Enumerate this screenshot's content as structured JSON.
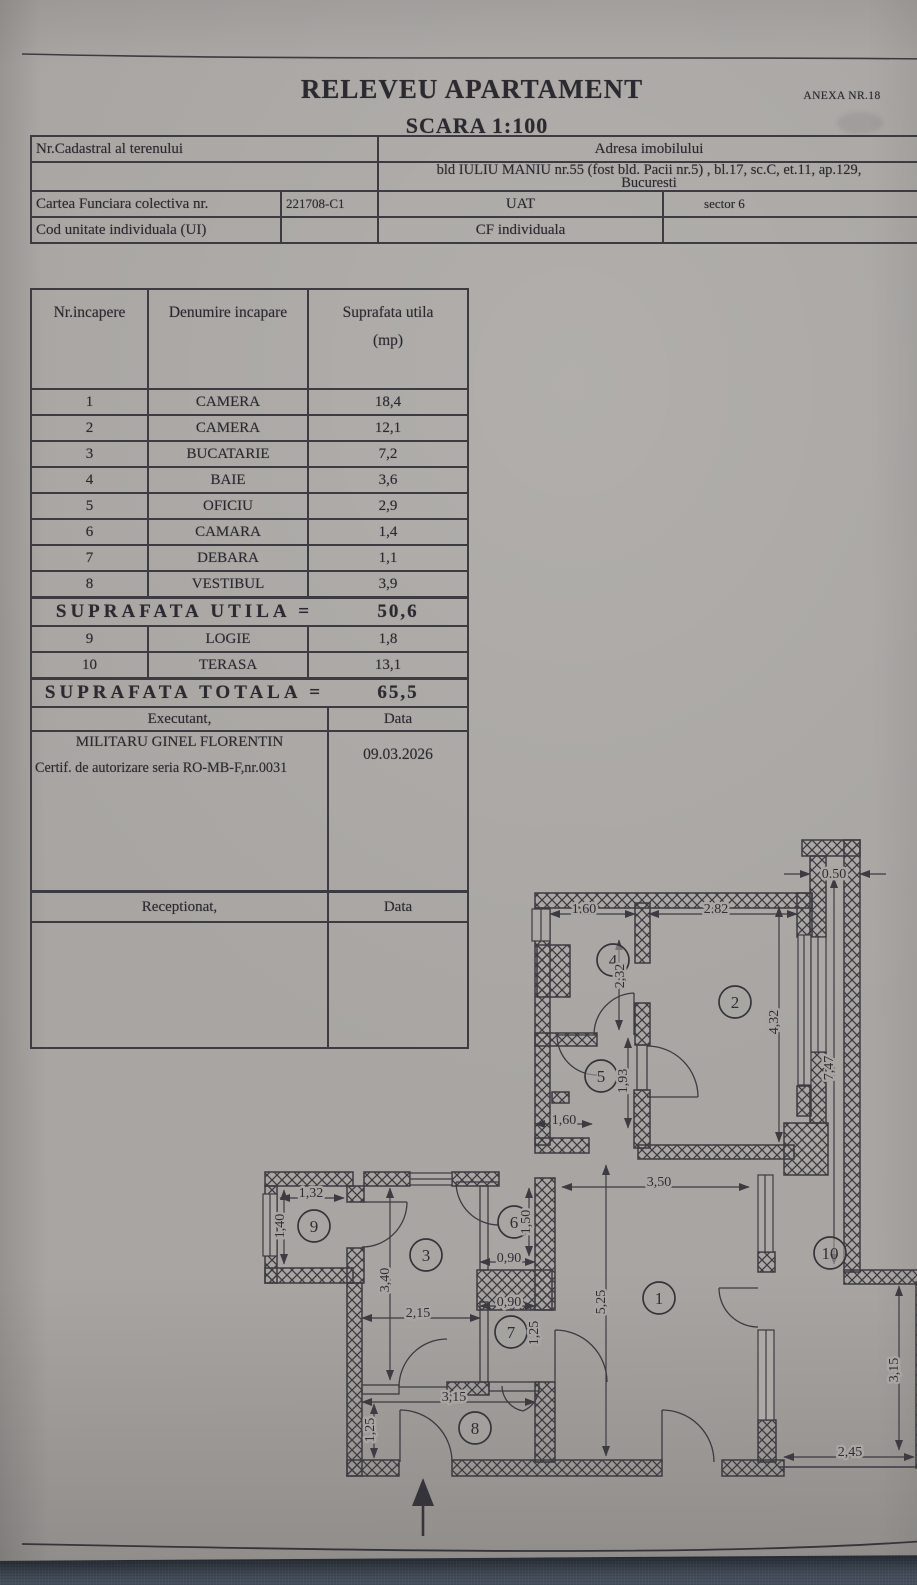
{
  "page": {
    "title": "RELEVEU APARTAMENT",
    "scale": "SCARA 1:100",
    "anexa": "ANEXA NR.18"
  },
  "info": {
    "nr_cadastral": "Nr.Cadastral al terenului",
    "adresa_label": "Adresa imobilului",
    "adresa1": "bld IULIU MANIU nr.55 (fost bld. Pacii nr.5) , bl.17, sc.C, et.11, ap.129,",
    "adresa2": "Bucuresti",
    "cfc_label": "Cartea Funciara colectiva nr.",
    "cfc_value": "221708-C1",
    "uat_label": "UAT",
    "uat_value": "sector 6",
    "cod_label": "Cod unitate individuala (UI)",
    "cfi_label": "CF individuala"
  },
  "rt": {
    "h1": "Nr.incapere",
    "h2": "Denumire incapare",
    "h3a": "Suprafata utila",
    "h3b": "(mp)",
    "rows": [
      {
        "nr": "1",
        "name": "CAMERA",
        "area": "18,4"
      },
      {
        "nr": "2",
        "name": "CAMERA",
        "area": "12,1"
      },
      {
        "nr": "3",
        "name": "BUCATARIE",
        "area": "7,2"
      },
      {
        "nr": "4",
        "name": "BAIE",
        "area": "3,6"
      },
      {
        "nr": "5",
        "name": "OFICIU",
        "area": "2,9"
      },
      {
        "nr": "6",
        "name": "CAMARA",
        "area": "1,4"
      },
      {
        "nr": "7",
        "name": "DEBARA",
        "area": "1,1"
      },
      {
        "nr": "8",
        "name": "VESTIBUL",
        "area": "3,9"
      }
    ],
    "utila_label": "SUPRAFATA UTILA =",
    "utila_value": "50,6",
    "rows2": [
      {
        "nr": "9",
        "name": "LOGIE",
        "area": "1,8"
      },
      {
        "nr": "10",
        "name": "TERASA",
        "area": "13,1"
      }
    ],
    "totala_label": "SUPRAFATA TOTALA =",
    "totala_value": "65,5",
    "executant": "Executant,",
    "data1": "Data",
    "name": "MILITARU GINEL FLORENTIN",
    "cert": "Certif. de autorizare seria RO-MB-F,nr.0031",
    "date": "09.03.2026",
    "receptionat": "Receptionat,",
    "data2": "Data"
  },
  "floorplan": {
    "rooms": [
      {
        "n": "1",
        "x": 637,
        "y": 1268
      },
      {
        "n": "2",
        "x": 713,
        "y": 972
      },
      {
        "n": "3",
        "x": 404,
        "y": 1225
      },
      {
        "n": "4",
        "x": 591,
        "y": 930
      },
      {
        "n": "5",
        "x": 579,
        "y": 1046
      },
      {
        "n": "6",
        "x": 492,
        "y": 1192
      },
      {
        "n": "7",
        "x": 489,
        "y": 1302
      },
      {
        "n": "8",
        "x": 453,
        "y": 1398
      },
      {
        "n": "9",
        "x": 292,
        "y": 1196
      },
      {
        "n": "10",
        "x": 808,
        "y": 1223
      }
    ],
    "dims": [
      {
        "t": "1.60",
        "x": 562,
        "y": 878,
        "r": 0
      },
      {
        "t": "2.82",
        "x": 694,
        "y": 878,
        "r": 0
      },
      {
        "t": "2,32",
        "x": 597,
        "y": 946,
        "r": 90
      },
      {
        "t": "4,32",
        "x": 751,
        "y": 992,
        "r": 90
      },
      {
        "t": "0.50",
        "x": 812,
        "y": 843,
        "r": 0
      },
      {
        "t": "7,47",
        "x": 806,
        "y": 1038,
        "r": 90
      },
      {
        "t": "1,93",
        "x": 600,
        "y": 1051,
        "r": 90
      },
      {
        "t": "1,60",
        "x": 542,
        "y": 1089,
        "r": 0
      },
      {
        "t": "3,50",
        "x": 637,
        "y": 1151,
        "r": 0
      },
      {
        "t": "5,25",
        "x": 578,
        "y": 1272,
        "r": 90
      },
      {
        "t": "1,32",
        "x": 289,
        "y": 1162,
        "r": 0
      },
      {
        "t": "1,40",
        "x": 257,
        "y": 1196,
        "r": 90
      },
      {
        "t": "3,40",
        "x": 362,
        "y": 1250,
        "r": 90
      },
      {
        "t": "2,15",
        "x": 396,
        "y": 1282,
        "r": 0
      },
      {
        "t": "1,50",
        "x": 503,
        "y": 1192,
        "r": 90
      },
      {
        "t": "0,90",
        "x": 487,
        "y": 1227,
        "r": 0
      },
      {
        "t": "0,90",
        "x": 487,
        "y": 1271,
        "r": 0
      },
      {
        "t": "1,25",
        "x": 511,
        "y": 1303,
        "r": 90
      },
      {
        "t": "3,15",
        "x": 432,
        "y": 1366,
        "r": 0
      },
      {
        "t": "1,25",
        "x": 347,
        "y": 1400,
        "r": 90
      },
      {
        "t": "2,45",
        "x": 828,
        "y": 1421,
        "r": 0
      },
      {
        "t": "3,15",
        "x": 871,
        "y": 1340,
        "r": 90
      }
    ]
  }
}
